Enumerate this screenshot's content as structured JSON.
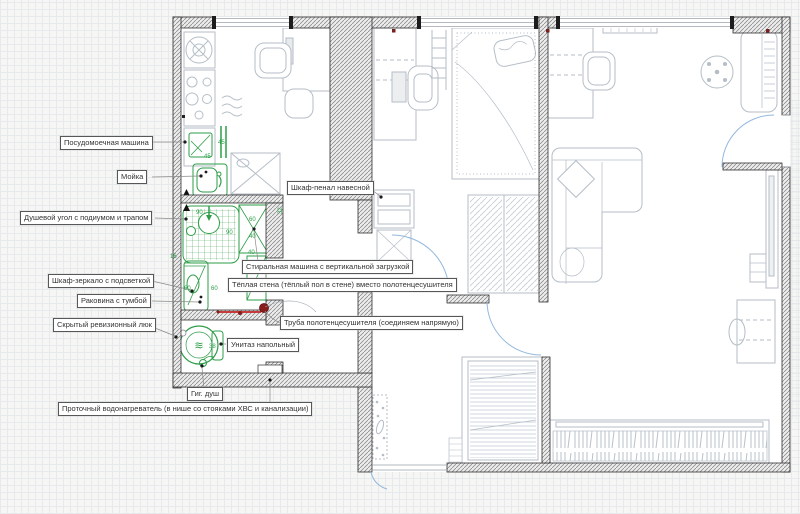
{
  "drawing": {
    "type": "apartment-floor-plan",
    "units_note": "dimension figures shown in centimetres"
  },
  "colors": {
    "fixture_green": "#2e9d48",
    "pipe_red": "#c62828",
    "pipe_dot_dark_red": "#8a1c1c",
    "door_arc_blue": "#92b8dd",
    "wall_dark": "#3a3a3a",
    "furniture_gray": "#b5bec7",
    "riser_blue": "#2b4fc0"
  },
  "callouts": {
    "dishwasher": "Посудомоечная машина",
    "kitchen_sink": "Мойка",
    "shower": "Душевой угол с подиумом и трапом",
    "mirror_cabinet": "Шкаф-зеркало с подсветкой",
    "vanity": "Раковина с тумбой",
    "revision_hatch": "Скрытый ревизионный люк",
    "tall_cabinet": "Шкаф-пенал навесной",
    "washer": "Стиральная машина с вертикальной загрузкой",
    "warm_wall": "Тёплая стена (тёплый пол в стене) вместо полотенцесушителя",
    "towel_pipe": "Труба полотенцесушителя (соединяем напрямую)",
    "toilet": "Унитаз напольный",
    "gig_shower": "Гиг. душ",
    "water_heater": "Проточный водонагреватель (в нише со стояками ХВС и канализации)"
  },
  "dims": {
    "rail_a": "45",
    "rail_b": "45",
    "shower_w": "90",
    "shower_d": "90",
    "gap_16": "16",
    "niche_32": "32",
    "washer_60": "60",
    "washer_40a": "40",
    "washer_40b": "40",
    "washer_40c": "40",
    "vanity_60a": "60",
    "vanity_60b": "60",
    "toilet_38": "38"
  },
  "symbols": {
    "toilet_swirl": "≋"
  }
}
